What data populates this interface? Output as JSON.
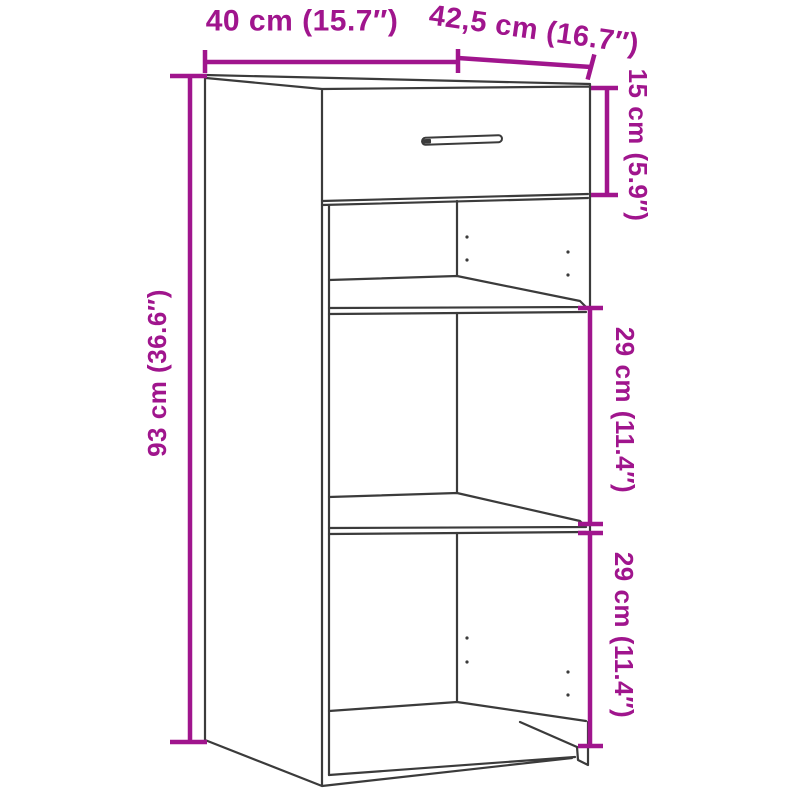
{
  "diagram": {
    "title": "Cabinet dimension diagram",
    "figure": "3D outline drawing of a tall narrow cabinet with one top drawer, two open shelf compartments and a plinth base",
    "colors": {
      "dimension": "#A0158D",
      "outline": "#3B3B3B",
      "background": "#FFFFFF"
    },
    "labels": {
      "width": "40 cm (15.7″)",
      "depth": "42,5 cm (16.7″)",
      "drawer_height": "15 cm (5.9″)",
      "upper_compartment_height": "29 cm (11.4″)",
      "lower_compartment_height": "29 cm (11.4″)",
      "total_height": "93 cm (36.6″)"
    }
  }
}
